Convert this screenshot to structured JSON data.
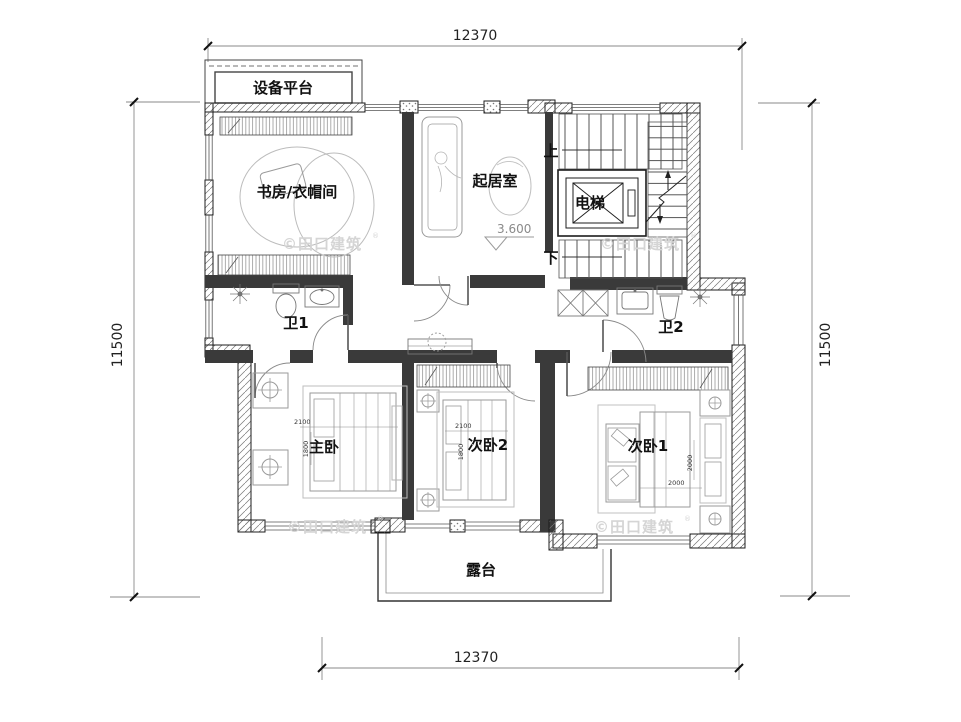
{
  "drawing": {
    "rooms": {
      "equipment_platform": "设备平台",
      "study_cloakroom": "书房/衣帽间",
      "living_room": "起居室",
      "elevator": "电梯",
      "bath1": "卫1",
      "bath2": "卫2",
      "master_bedroom": "主卧",
      "bedroom2": "次卧2",
      "bedroom1": "次卧1",
      "terrace": "露台"
    },
    "stairs": {
      "up": "上",
      "down": "下"
    },
    "level_marker": "3.600",
    "dims": {
      "top": "12370",
      "bottom": "12370",
      "left": "11500",
      "right": "11500",
      "master_bed_w": "2100",
      "master_bed_d": "1800",
      "bed2_w": "2100",
      "bed2_d": "1800",
      "bed1_w": "2000",
      "bed1_d": "2000"
    },
    "watermark": "©田口建筑",
    "watermark_reg": "®",
    "colors": {
      "line": "#1c1c1c",
      "interior_wall": "#3a3a3a",
      "furniture": "#9a9a9a",
      "watermark": "#d5d5d5"
    }
  }
}
